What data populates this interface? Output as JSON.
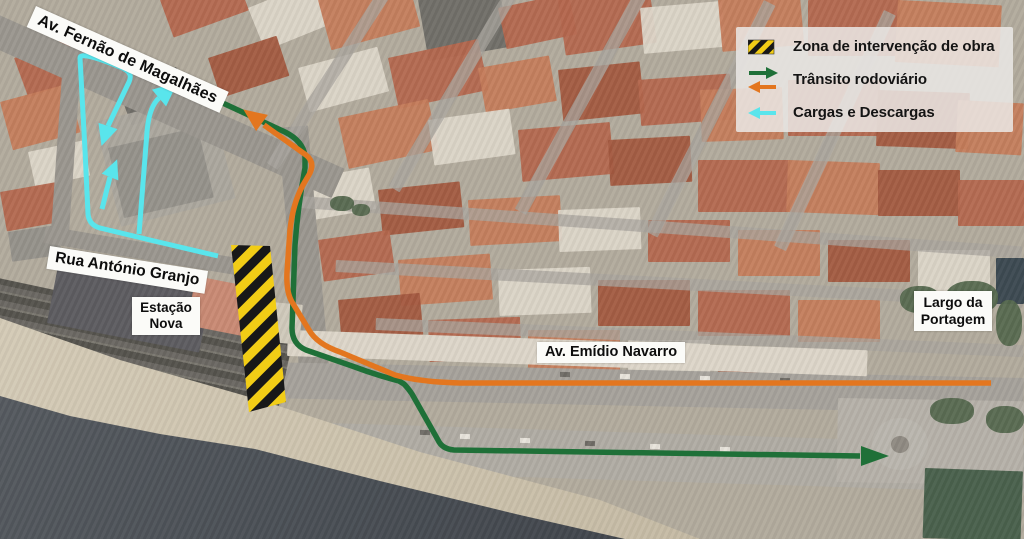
{
  "legend": {
    "items": [
      {
        "icon": "hazard-stripes-swatch",
        "label": "Zona de intervenção de obra"
      },
      {
        "icon": "green-right-and-orange-left-arrows",
        "label": "Trânsito rodoviário"
      },
      {
        "icon": "cyan-left-arrow",
        "label": "Cargas e Descargas"
      }
    ]
  },
  "street_labels": {
    "avenue": "Av. Fernão de Magalhães",
    "granjo": "Rua António Granjo",
    "estacao_1": "Estação",
    "estacao_2": "Nova",
    "navarro": "Av. Emídio Navarro",
    "largo_1": "Largo da",
    "largo_2": "Portagem"
  },
  "colors": {
    "transit_outbound_green": "#1f7038",
    "transit_inbound_orange": "#e3761f",
    "loading_cyan": "#59e5ec",
    "hazard_yellow": "#f2cd16",
    "hazard_black": "#181818"
  },
  "routes": {
    "transit_outbound": {
      "color": "#1f7038",
      "width": 5.5,
      "paths": [
        "M 86,40 L 240,111 L 285,132 Q 303,141 305,156 L 305,168 Q 298,205 295,245 L 292,328 Q 292,344 306,350 L 352,366 Q 376,375 399,381 L 404,384 Q 408,388 412,394 L 438,440 Q 442,449 454,450 L 860,456"
      ],
      "arrows": [
        {
          "x": 172,
          "y": 81,
          "angle": 25,
          "len": 22,
          "half_w": 9
        },
        {
          "x": 861,
          "y": 456,
          "angle": 0,
          "len": 28,
          "half_w": 10
        }
      ]
    },
    "transit_inbound": {
      "color": "#e3761f",
      "width": 5.5,
      "paths": [
        "M 991,383 L 460,383 Q 420,382 395,375 L 340,352 Q 317,344 309,330 L 292,302 Q 286,292 287,272 L 290,230 Q 293,203 303,185 L 310,173 Q 315,162 306,155 L 264,125"
      ],
      "arrows": [
        {
          "x": 262,
          "y": 123,
          "angle": 216,
          "len": 23,
          "half_w": 10
        }
      ]
    },
    "loading": {
      "color": "#59e5ec",
      "width": 5,
      "paths": [
        "M 127,70 Q 80,50 80,58 L 85,150 L 88,214 Q 89,225 100,228 L 150,240 L 218,256",
        "M 124,69 Q 133,73 129,82 L 108,126",
        "M 139,234 L 147,132 Q 149,107 159,98",
        "M 102,209 L 110,177"
      ],
      "arrows": [
        {
          "x": 108,
          "y": 126,
          "angle": 108,
          "len": 21,
          "half_w": 10
        },
        {
          "x": 159,
          "y": 98,
          "angle": -40,
          "len": 24,
          "half_w": 11
        },
        {
          "x": 110,
          "y": 177,
          "angle": -68,
          "len": 19,
          "half_w": 9
        }
      ]
    }
  },
  "hazard_zone": {
    "points": "231,245 270,246 286,402 249,412",
    "stripe_yellow": "#f2cd16",
    "stripe_black": "#181818"
  }
}
